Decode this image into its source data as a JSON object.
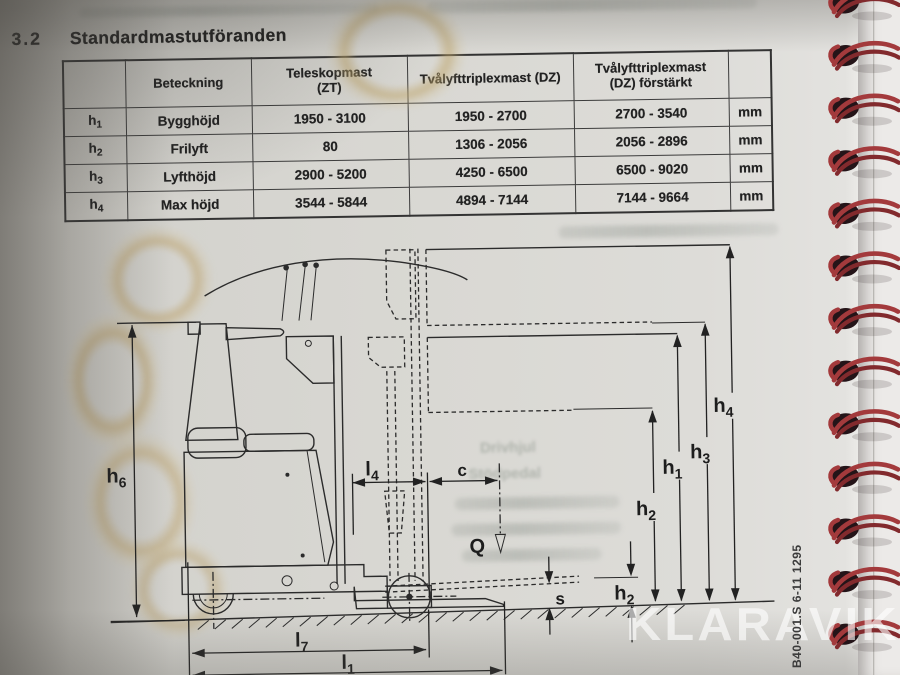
{
  "page": {
    "section_number": "3.2",
    "section_title": "Standardmastutföranden",
    "doc_code": "B40-001.S 6-11 1295",
    "watermark": "KLARAVIK"
  },
  "table": {
    "col_headers": {
      "designation": "Beteckning",
      "teleskopmast_line1": "Teleskopmast",
      "teleskopmast_line2": "(ZT)",
      "triplex_dz": "Tvålyfttriplexmast (DZ)",
      "triplex_dz_forstarkt_line1": "Tvålyfttriplexmast",
      "triplex_dz_forstarkt_line2": "(DZ) förstärkt"
    },
    "rows": [
      {
        "sym": "h",
        "sub": "1",
        "designation": "Bygghöjd",
        "zt": "1950 - 3100",
        "dz": "1950 - 2700",
        "dz_forstarkt": "2700 - 3540",
        "unit": "mm"
      },
      {
        "sym": "h",
        "sub": "2",
        "designation": "Frilyft",
        "zt": "80",
        "dz": "1306 - 2056",
        "dz_forstarkt": "2056 - 2896",
        "unit": "mm"
      },
      {
        "sym": "h",
        "sub": "3",
        "designation": "Lyfthöjd",
        "zt": "2900 - 5200",
        "dz": "4250 - 6500",
        "dz_forstarkt": "6500 - 9020",
        "unit": "mm"
      },
      {
        "sym": "h",
        "sub": "4",
        "designation": "Max höjd",
        "zt": "3544 - 5844",
        "dz": "4894 - 7144",
        "dz_forstarkt": "7144 - 9664",
        "unit": "mm"
      }
    ]
  },
  "diagram": {
    "labels": {
      "h6": {
        "base": "h",
        "sub": "6"
      },
      "h4": {
        "base": "h",
        "sub": "4"
      },
      "h3": {
        "base": "h",
        "sub": "3"
      },
      "h1": {
        "base": "h",
        "sub": "1"
      },
      "h2_upper": {
        "base": "h",
        "sub": "2"
      },
      "h2_lower": {
        "base": "h",
        "sub": "2"
      },
      "l4": {
        "base": "l",
        "sub": "4"
      },
      "l7": {
        "base": "l",
        "sub": "7"
      },
      "l1": {
        "base": "l",
        "sub": "1"
      },
      "c": "c",
      "s": "s",
      "load": "Q"
    },
    "ghost_text": {
      "line1": "Drivhjul",
      "line2": "Stödpedal"
    }
  },
  "binding": {
    "ring_count": 13,
    "wire_color": "#9c3236",
    "hole_color": "#241418"
  },
  "colors": {
    "paper": "#d8d7d2",
    "ink": "#242424"
  }
}
